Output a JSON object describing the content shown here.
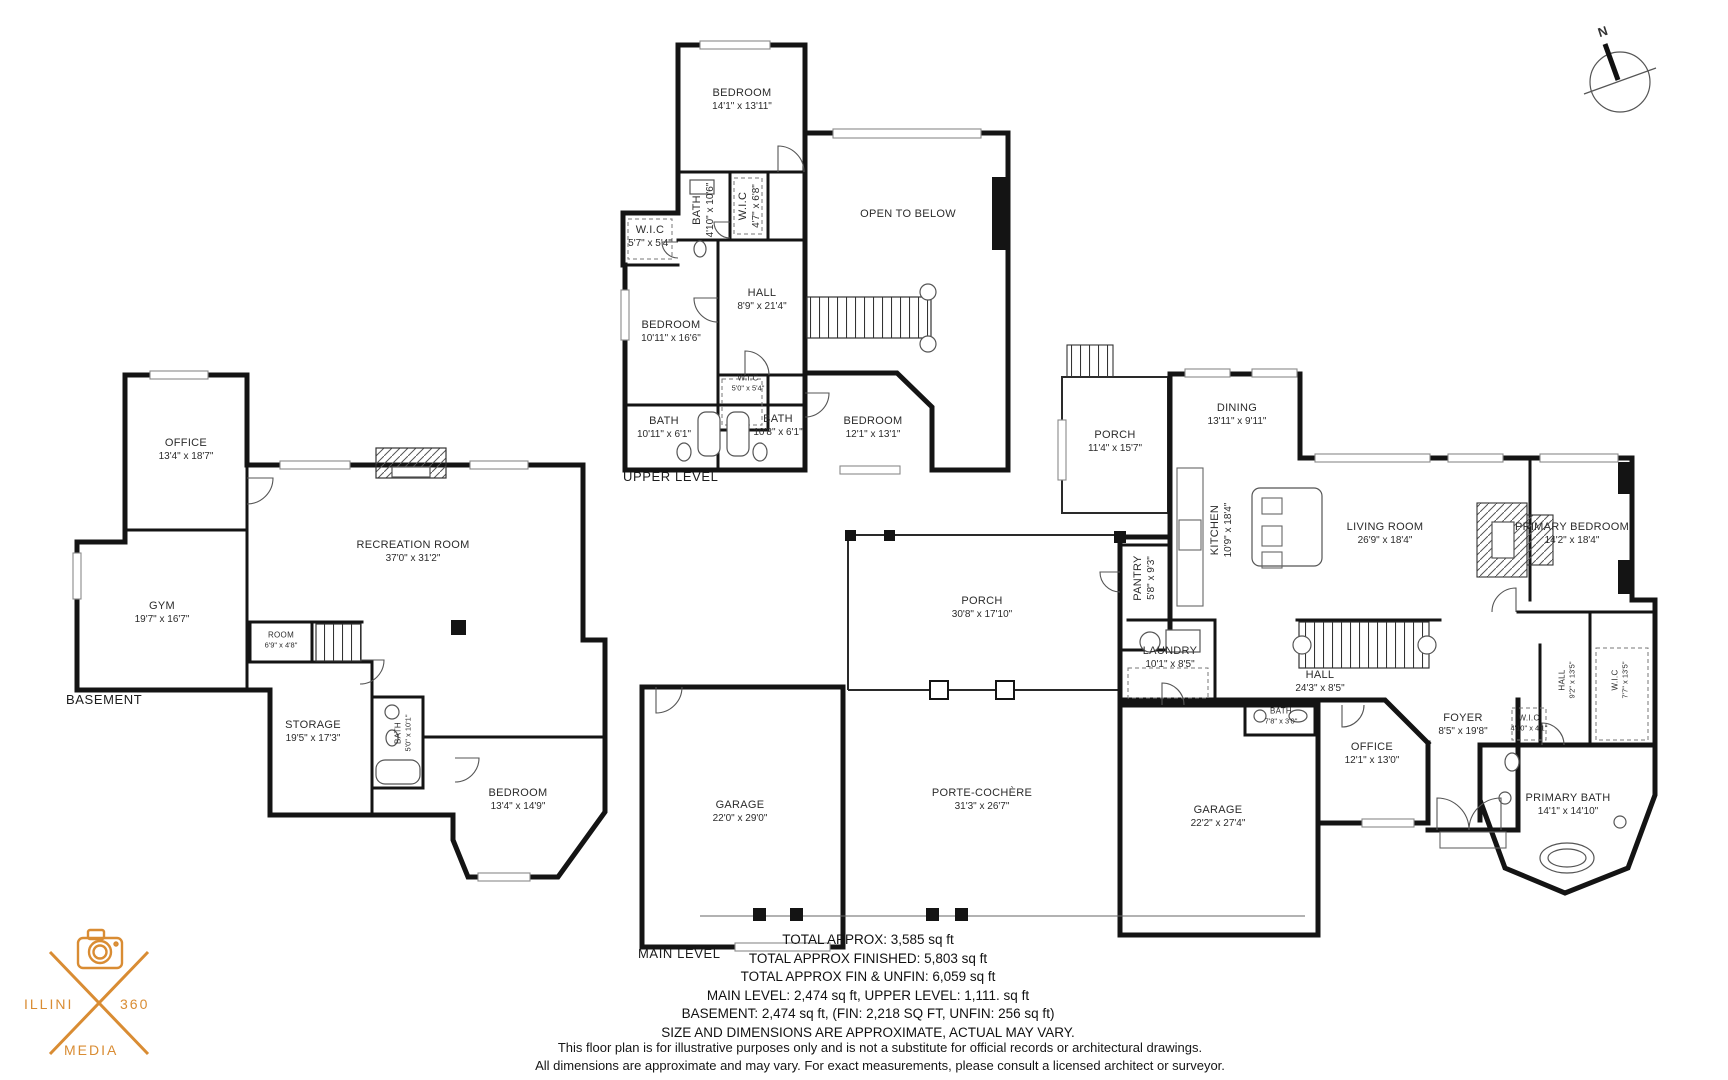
{
  "page": {
    "background": "#ffffff"
  },
  "compass": {
    "label": "N"
  },
  "logo": {
    "word_left": "ILLINI",
    "word_right": "360",
    "word_bottom": "MEDIA",
    "color": "#d98c33"
  },
  "levels": {
    "upper": {
      "title": "UPPER LEVEL",
      "rooms": [
        {
          "name": "BEDROOM",
          "dims": "14'1\" x 13'11\""
        },
        {
          "name": "BATH",
          "dims": "4'10\" x 10'6\""
        },
        {
          "name": "W.I.C",
          "dims": "4'7\" x 6'8\""
        },
        {
          "name": "W.I.C",
          "dims": "5'7\" x 5'4\""
        },
        {
          "name": "BEDROOM",
          "dims": "10'11\" x 16'6\""
        },
        {
          "name": "HALL",
          "dims": "8'9\" x 21'4\""
        },
        {
          "name": "OPEN TO BELOW",
          "dims": ""
        },
        {
          "name": "W.I.C",
          "dims": "5'0\" x 5'4\""
        },
        {
          "name": "BATH",
          "dims": "10'11\" x 6'1\""
        },
        {
          "name": "BATH",
          "dims": "10'8\" x 6'1\""
        },
        {
          "name": "BEDROOM",
          "dims": "12'1\" x 13'1\""
        }
      ]
    },
    "basement": {
      "title": "BASEMENT",
      "rooms": [
        {
          "name": "OFFICE",
          "dims": "13'4\" x 18'7\""
        },
        {
          "name": "GYM",
          "dims": "19'7\" x 16'7\""
        },
        {
          "name": "RECREATION ROOM",
          "dims": "37'0\" x 31'2\""
        },
        {
          "name": "ROOM",
          "dims": "6'9\" x 4'8\""
        },
        {
          "name": "STORAGE",
          "dims": "19'5\" x 17'3\""
        },
        {
          "name": "BATH",
          "dims": "5'0\" x 10'1\""
        },
        {
          "name": "BEDROOM",
          "dims": "13'4\" x 14'9\""
        }
      ]
    },
    "main": {
      "title": "MAIN LEVEL",
      "rooms": [
        {
          "name": "PORCH",
          "dims": "11'4\" x 15'7\""
        },
        {
          "name": "DINING",
          "dims": "13'11\" x 9'11\""
        },
        {
          "name": "KITCHEN",
          "dims": "10'9\" x 18'4\""
        },
        {
          "name": "PANTRY",
          "dims": "5'8\" x 9'3\""
        },
        {
          "name": "LIVING ROOM",
          "dims": "26'9\" x 18'4\""
        },
        {
          "name": "PRIMARY BEDROOM",
          "dims": "14'2\" x 18'4\""
        },
        {
          "name": "PORCH",
          "dims": "30'8\" x 17'10\""
        },
        {
          "name": "LAUNDRY",
          "dims": "10'1\" x 8'5\""
        },
        {
          "name": "HALL",
          "dims": "24'3\" x 8'5\""
        },
        {
          "name": "BATH",
          "dims": "7'8\" x 3'0\""
        },
        {
          "name": "HALL",
          "dims": "9'2\" x 13'5\""
        },
        {
          "name": "W.I.C",
          "dims": "7'7\" x 13'5\""
        },
        {
          "name": "W.I.C",
          "dims": "4'10\" x 4'1\""
        },
        {
          "name": "OFFICE",
          "dims": "12'1\" x 13'0\""
        },
        {
          "name": "FOYER",
          "dims": "8'5\" x 19'8\""
        },
        {
          "name": "GARAGE",
          "dims": "22'0\" x 29'0\""
        },
        {
          "name": "PORTE-COCHÈRE",
          "dims": "31'3\" x 26'7\""
        },
        {
          "name": "GARAGE",
          "dims": "22'2\" x 27'4\""
        },
        {
          "name": "PRIMARY BATH",
          "dims": "14'1\" x 14'10\""
        }
      ]
    }
  },
  "summary": {
    "l1": "TOTAL APPROX: 3,585 sq ft",
    "l2": "TOTAL APPROX FINISHED: 5,803 sq ft",
    "l3": "TOTAL APPROX FIN & UNFIN: 6,059 sq ft",
    "l4": "MAIN LEVEL: 2,474 sq ft, UPPER LEVEL: 1,111. sq ft",
    "l5": "BASEMENT: 2,474 sq ft, (FIN: 2,218 SQ FT, UNFIN: 256 sq ft)",
    "l6": "SIZE AND DIMENSIONS ARE APPROXIMATE, ACTUAL MAY VARY."
  },
  "disclaimer": {
    "l1": "This floor plan is for illustrative purposes only and is not a substitute for official records or architectural drawings.",
    "l2": "All dimensions are approximate and may vary. For exact measurements, please consult a licensed architect or surveyor."
  }
}
